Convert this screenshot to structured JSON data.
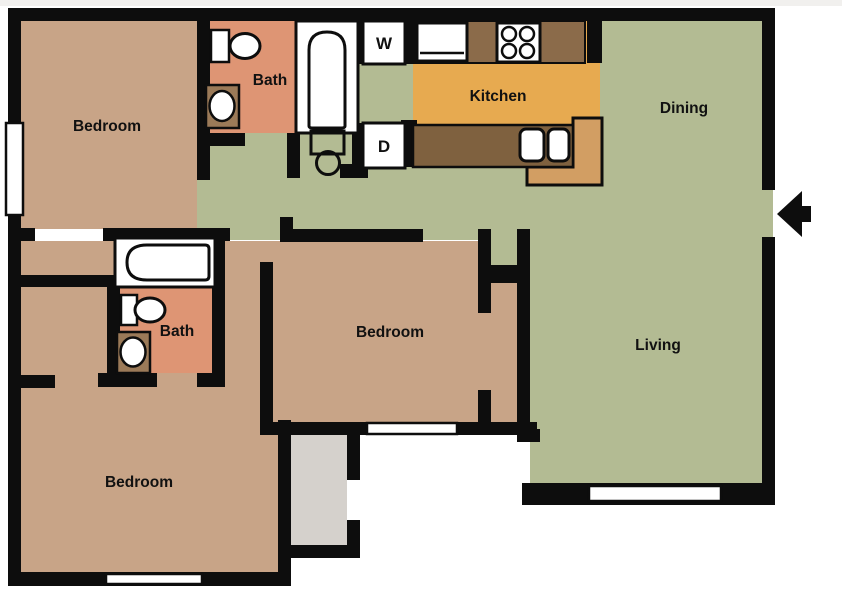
{
  "palette": {
    "wall": "#0d0d0d",
    "bedroomTan": "#c8a487",
    "bathSalmon": "#de9574",
    "hallGreen": "#b3bb93",
    "kitchenOrange": "#e7aa50",
    "counterBrown": "#8b6b4a",
    "counterDark": "#7f613f",
    "breakfastBar": "#d29e63",
    "cabinetBrown": "#9b7a58",
    "patioGray": "#d5d1cc",
    "fixtureWhite": "#ffffff",
    "labelInk": "#111111",
    "background": "#ffffff"
  },
  "floorplan": {
    "type": "apartment-floor-plan",
    "rooms": {
      "bedroom_top_left": {
        "label": "Bedroom"
      },
      "bath_top": {
        "label": "Bath"
      },
      "kitchen": {
        "label": "Kitchen"
      },
      "dining": {
        "label": "Dining"
      },
      "living": {
        "label": "Living"
      },
      "bedroom_middle": {
        "label": "Bedroom"
      },
      "bath_middle": {
        "label": "Bath"
      },
      "bedroom_bottom_left": {
        "label": "Bedroom"
      },
      "washer": {
        "label": "W"
      },
      "dryer": {
        "label": "D"
      }
    },
    "fixtures": [
      "toilet",
      "vanity-sink",
      "bathtub",
      "washer",
      "dryer",
      "water-heater",
      "refrigerator",
      "stove",
      "kitchen-double-sink",
      "counter",
      "breakfast-bar",
      "window",
      "patio",
      "entry-door-arrow"
    ]
  }
}
